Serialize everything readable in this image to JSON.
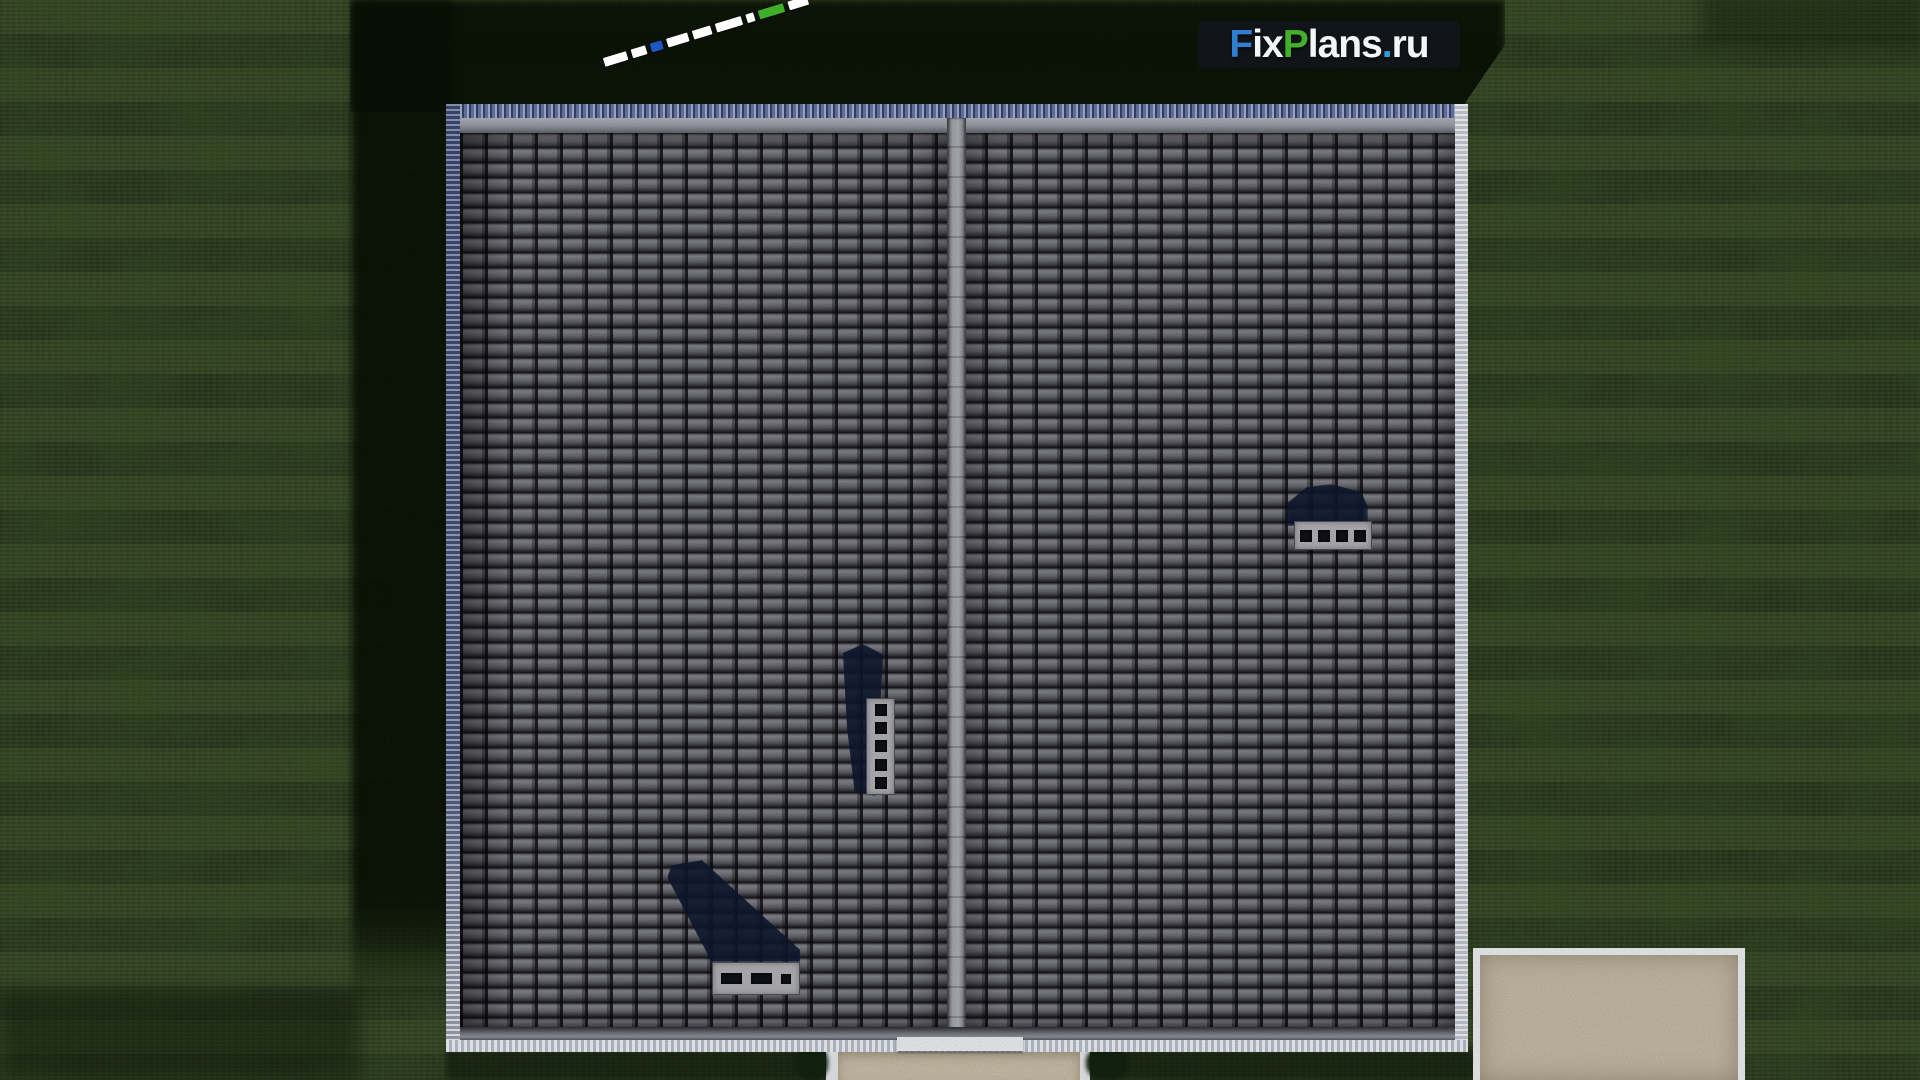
{
  "logo": {
    "text": "FixPlans.ru",
    "panel_color": "rgba(18,22,28,0.88)",
    "parts": [
      {
        "text": "F",
        "color": "#2e7ed2"
      },
      {
        "text": "ix",
        "color": "#f3f5f7"
      },
      {
        "text": "P",
        "color": "#43b02a"
      },
      {
        "text": "lans",
        "color": "#f3f5f7"
      },
      {
        "text": ".",
        "color": "#2d9fe0"
      },
      {
        "text": "ru",
        "color": "#f3f5f7"
      }
    ]
  },
  "scale_bar": {
    "angle_deg": -17,
    "segments": [
      {
        "color": "#ffffff",
        "width": "24px"
      },
      {
        "color": "#ffffff",
        "width": "15px"
      },
      {
        "color": "#1e56c8",
        "width": "12px"
      },
      {
        "color": "#ffffff",
        "width": "22px"
      },
      {
        "color": "#ffffff",
        "width": "19px"
      },
      {
        "color": "#ffffff",
        "width": "27px"
      },
      {
        "color": "#ffffff",
        "width": "8px"
      },
      {
        "color": "#3fae28",
        "width": "26px"
      },
      {
        "color": "#ffffff",
        "width": "20px"
      }
    ]
  },
  "scene": {
    "view": "aerial top-down render of a gable-roof house on a lawn",
    "roof": {
      "planes": 2,
      "tile_color": "#5e5e66",
      "ridge_color": "#9fa1a9",
      "edging_shadow_side": "#5a6a9c",
      "edging_lit_side": "#e3e6ec"
    },
    "chimneys": [
      {
        "location": "left plane, near ridge",
        "orientation": "vertical",
        "openings": 5
      },
      {
        "location": "right plane, upper area",
        "orientation": "horizontal",
        "openings": 4
      },
      {
        "location": "left plane, lower edge",
        "orientation": "horizontal",
        "openings": 3
      }
    ],
    "ground": {
      "grass_color": "#2e3d20",
      "shadow_color": "#081005",
      "patio_color": "#c6bda6",
      "path_color": "#c9c0a9",
      "step_color": "#eef0f4"
    }
  }
}
